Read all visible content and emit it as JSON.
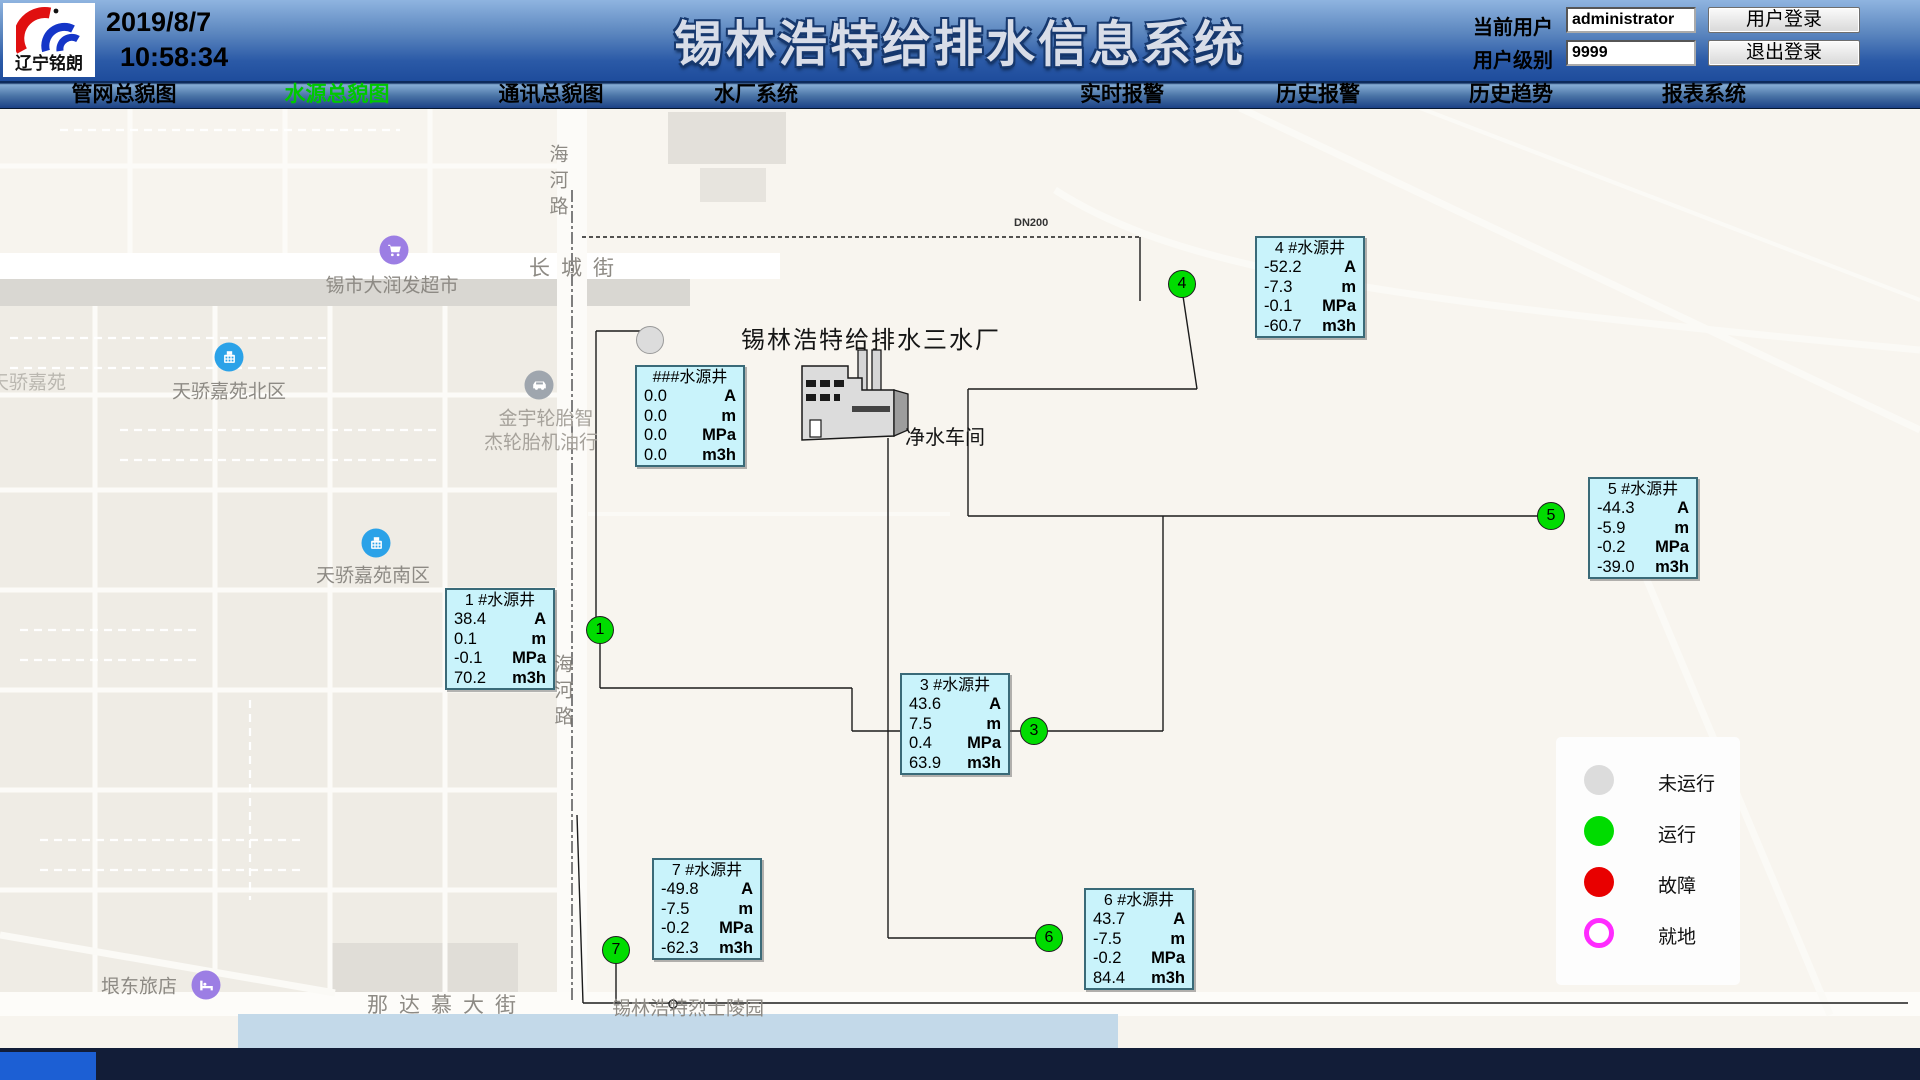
{
  "header": {
    "logo_text": "辽宁铭朗",
    "date": "2019/8/7",
    "time": "10:58:34",
    "title": "锡林浩特给排水信息系统",
    "current_user_label": "当前用户",
    "current_user_value": "administrator",
    "user_level_label": "用户级别",
    "user_level_value": "9999",
    "login_button": "用户登录",
    "logout_button": "退出登录"
  },
  "nav": {
    "active_color": "#00C800",
    "items": [
      {
        "label": "管网总貌图",
        "x": 124,
        "active": false
      },
      {
        "label": "水源总貌图",
        "x": 337,
        "active": true
      },
      {
        "label": "通讯总貌图",
        "x": 551,
        "active": false
      },
      {
        "label": "水厂系统",
        "x": 756,
        "active": false
      },
      {
        "label": "实时报警",
        "x": 1122,
        "active": false
      },
      {
        "label": "历史报警",
        "x": 1318,
        "active": false
      },
      {
        "label": "历史趋势",
        "x": 1511,
        "active": false
      },
      {
        "label": "报表系统",
        "x": 1704,
        "active": false
      }
    ]
  },
  "map": {
    "plant": {
      "name": "锡林浩特给排水三水厂",
      "workshop": "净水车间",
      "pipe_label": "DN200"
    },
    "wells": [
      {
        "id": "unnamed",
        "title": "###水源井",
        "x": 635,
        "y": 365,
        "circle": {
          "x": 650,
          "y": 340,
          "num": "",
          "status": "stopped"
        },
        "rows": [
          [
            "0.0",
            "A"
          ],
          [
            "0.0",
            "m"
          ],
          [
            "0.0",
            "MPa"
          ],
          [
            "0.0",
            "m3h"
          ]
        ]
      },
      {
        "id": "well-1",
        "title": "1  #水源井",
        "x": 445,
        "y": 588,
        "circle": {
          "x": 600,
          "y": 630,
          "num": "1",
          "status": "running"
        },
        "rows": [
          [
            "38.4",
            "A"
          ],
          [
            "0.1",
            "m"
          ],
          [
            "-0.1",
            "MPa"
          ],
          [
            "70.2",
            "m3h"
          ]
        ]
      },
      {
        "id": "well-3",
        "title": "3  #水源井",
        "x": 900,
        "y": 673,
        "circle": {
          "x": 1034,
          "y": 731,
          "num": "3",
          "status": "running"
        },
        "rows": [
          [
            "43.6",
            "A"
          ],
          [
            "7.5",
            "m"
          ],
          [
            "0.4",
            "MPa"
          ],
          [
            "63.9",
            "m3h"
          ]
        ]
      },
      {
        "id": "well-4",
        "title": "4  #水源井",
        "x": 1255,
        "y": 236,
        "circle": {
          "x": 1182,
          "y": 284,
          "num": "4",
          "status": "running"
        },
        "rows": [
          [
            "-52.2",
            "A"
          ],
          [
            "-7.3",
            "m"
          ],
          [
            "-0.1",
            "MPa"
          ],
          [
            "-60.7",
            "m3h"
          ]
        ]
      },
      {
        "id": "well-5",
        "title": "5  #水源井",
        "x": 1588,
        "y": 477,
        "circle": {
          "x": 1551,
          "y": 516,
          "num": "5",
          "status": "running"
        },
        "rows": [
          [
            "-44.3",
            "A"
          ],
          [
            "-5.9",
            "m"
          ],
          [
            "-0.2",
            "MPa"
          ],
          [
            "-39.0",
            "m3h"
          ]
        ]
      },
      {
        "id": "well-6",
        "title": "6  #水源井",
        "x": 1084,
        "y": 888,
        "circle": {
          "x": 1049,
          "y": 938,
          "num": "6",
          "status": "running"
        },
        "rows": [
          [
            "43.7",
            "A"
          ],
          [
            "-7.5",
            "m"
          ],
          [
            "-0.2",
            "MPa"
          ],
          [
            "84.4",
            "m3h"
          ]
        ]
      },
      {
        "id": "well-7",
        "title": "7  #水源井",
        "x": 652,
        "y": 858,
        "circle": {
          "x": 616,
          "y": 950,
          "num": "7",
          "status": "running"
        },
        "rows": [
          [
            "-49.8",
            "A"
          ],
          [
            "-7.5",
            "m"
          ],
          [
            "-0.2",
            "MPa"
          ],
          [
            "-62.3",
            "m3h"
          ]
        ]
      }
    ],
    "labels": [
      {
        "text": "长城街",
        "x": 577,
        "y": 267,
        "style": "spaced"
      },
      {
        "text": "锡市大润发超市",
        "x": 392,
        "y": 284,
        "style": ""
      },
      {
        "text": "天骄嘉苑",
        "x": 28,
        "y": 381,
        "style": "faint"
      },
      {
        "text": "天骄嘉苑北区",
        "x": 229,
        "y": 390,
        "style": ""
      },
      {
        "text": "金宇轮胎智",
        "x": 546,
        "y": 417,
        "style": "light"
      },
      {
        "text": "杰轮胎机油行",
        "x": 541,
        "y": 441,
        "style": "light"
      },
      {
        "text": "天骄嘉苑南区",
        "x": 373,
        "y": 574,
        "style": ""
      },
      {
        "text": "垠东旅店",
        "x": 139,
        "y": 985,
        "style": ""
      },
      {
        "text": "那达慕大街",
        "x": 447,
        "y": 1004,
        "style": "spaced"
      },
      {
        "text": "锡林浩特烈士陵园",
        "x": 688,
        "y": 1007,
        "style": ""
      },
      {
        "text": "海河路",
        "x": 557,
        "y": 183,
        "style": "vert"
      },
      {
        "text": "海河路",
        "x": 562,
        "y": 693,
        "style": "vert"
      }
    ],
    "pois": [
      {
        "icon": "cart",
        "name": "supermarket",
        "color": "#9C7EE4",
        "x": 394,
        "y": 250
      },
      {
        "icon": "building",
        "name": "residence-north",
        "color": "#2BA2E8",
        "x": 229,
        "y": 357
      },
      {
        "icon": "car",
        "name": "tire-shop",
        "color": "#9FA6AE",
        "x": 539,
        "y": 385
      },
      {
        "icon": "building",
        "name": "residence-south",
        "color": "#2BA2E8",
        "x": 376,
        "y": 543
      },
      {
        "icon": "bed",
        "name": "hotel",
        "color": "#9C7EE4",
        "x": 206,
        "y": 985
      }
    ],
    "legend": {
      "items": [
        {
          "label": "未运行",
          "color": "#DCDCDC",
          "type": "filled"
        },
        {
          "label": "运行",
          "color": "#00DC00",
          "type": "filled"
        },
        {
          "label": "故障",
          "color": "#E80000",
          "type": "filled"
        },
        {
          "label": "就地",
          "color": "#FF2BFF",
          "type": "ring"
        }
      ]
    },
    "colors": {
      "well_box_bg": "#C9F3FB",
      "running": "#00DC00",
      "stopped": "#DCDCDC",
      "fault": "#E80000",
      "local": "#FF2BFF"
    }
  }
}
